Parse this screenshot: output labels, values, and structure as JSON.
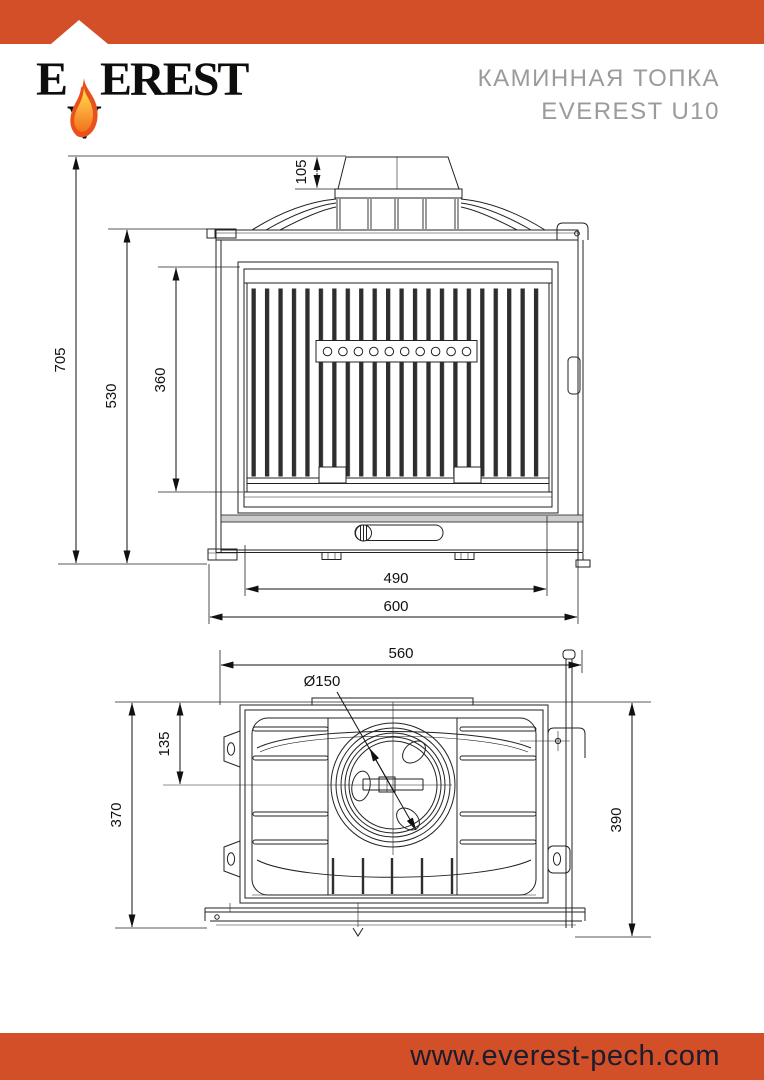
{
  "page": {
    "width": 764,
    "height": 1080,
    "background": "#ffffff"
  },
  "header": {
    "banner_color": "#d24f27",
    "logo": {
      "text_start": "E",
      "text_flame_letter": "V",
      "text_end": "EREST"
    },
    "product_title_line1": "КАМИННАЯ ТОПКА",
    "product_title_line2": "EVEREST U10",
    "title_color": "#9b9b9b"
  },
  "front_view": {
    "name": "front view drawing",
    "dims": {
      "flue_collar_height": "105",
      "overall_height": "705",
      "body_height": "530",
      "door_glass_height": "360",
      "base_width": "490",
      "overall_width": "600"
    }
  },
  "top_view": {
    "name": "top view drawing",
    "dims": {
      "body_width": "560",
      "flue_diameter": "Ø150",
      "flue_center_offset": "135",
      "body_depth": "370",
      "overall_depth": "390"
    }
  },
  "footer": {
    "banner_color": "#d24f27",
    "website": "www.everest-pech.com"
  }
}
